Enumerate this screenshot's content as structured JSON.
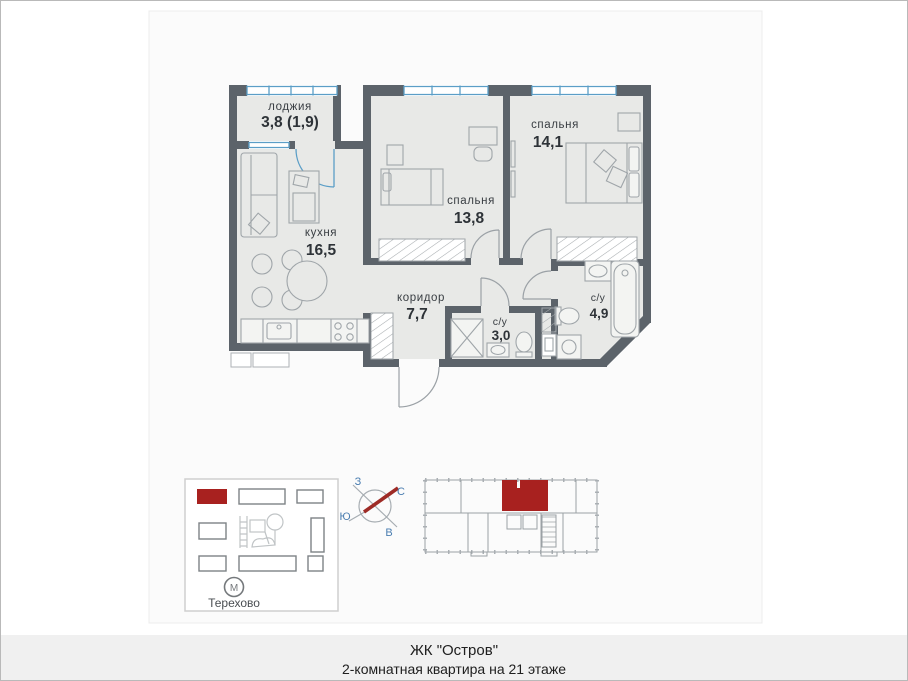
{
  "footer": {
    "line1": "ЖК \"Остров\"",
    "line2": "2-комнатная квартира на 21 этаже"
  },
  "plan": {
    "rooms": [
      {
        "name": "лоджия",
        "area": "3,8 (1,9)"
      },
      {
        "name": "кухня",
        "area": "16,5"
      },
      {
        "name": "спальня",
        "area": "13,8"
      },
      {
        "name": "спальня",
        "area": "14,1"
      },
      {
        "name": "коридор",
        "area": "7,7"
      },
      {
        "name": "с/у",
        "area": "3,0"
      },
      {
        "name": "с/у",
        "area": "4,9"
      }
    ]
  },
  "site_map": {
    "metro": {
      "symbol": "М",
      "label": "Терехово"
    }
  },
  "compass": {
    "west": "З",
    "north": "С",
    "south": "Ю",
    "east": "В"
  },
  "colors": {
    "wall": "#5c636a",
    "floor": "#e8e9e7",
    "window_blue": "#5b9ec7",
    "accent_red": "#a8211f",
    "compass_blue": "#4a7db0"
  }
}
